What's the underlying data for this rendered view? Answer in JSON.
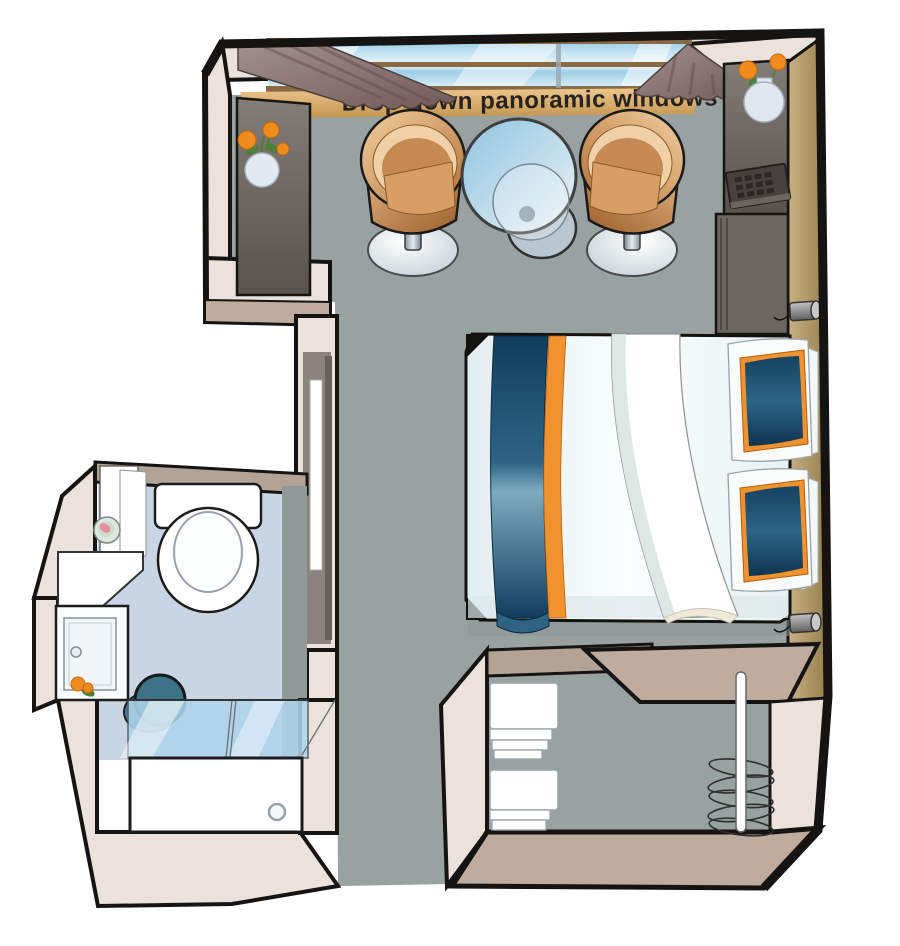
{
  "title": "Cabin floor plan",
  "labels": {
    "windows": "Drop-down panoramic windows"
  },
  "palette": {
    "floor": "#98A2A0",
    "bath_floor": "#C9D5E3",
    "wall_light": "#EAE2DB",
    "wall_band": "#B3A396",
    "wall_band_warm": "#BEAC9E",
    "outline": "#161412",
    "wall_tan_1": "#C8B183",
    "wall_tan_2": "#97814F",
    "console_1": "#827D78",
    "console_2": "#57524D",
    "curtain_1": "#A3918E",
    "curtain_2": "#6F5B58",
    "glass_1": "#9ECFE6",
    "glass_2": "#EAF6FA",
    "frame_brown": "#8A6A45",
    "sill_1": "#EDC68D",
    "sill_2": "#C3954F",
    "chair_1": "#F2CFA0",
    "chair_2": "#B06F35",
    "bed_white": "#F2F8F9",
    "runner_dark": "#123D5C",
    "runner_mid": "#2F6486",
    "runner_light": "#7FABC0",
    "orange": "#F0922E",
    "teal": "#3E7286",
    "lamp": "#9A9A9A",
    "flower": "#F08C1E",
    "leaf": "#4E7F3A",
    "text": "#262220",
    "white": "#FFFFFF",
    "shower_glass": "#AFD4EA",
    "recess_gray": "#8A837D"
  },
  "items": [
    "panoramic window",
    "curtain left",
    "curtain right",
    "armchair left",
    "armchair right",
    "cocktail table",
    "double bed",
    "bed runner",
    "pillow",
    "pillow",
    "reading lamp",
    "reading lamp",
    "console with vase",
    "safe keypad",
    "cabinet",
    "full-length mirror",
    "toilet",
    "vanity counter",
    "washbasin cabinet",
    "bathroom mirror",
    "soap dish",
    "shower stool",
    "shower glass screen",
    "shower tray",
    "towel shelves",
    "wardrobe clothes rail",
    "hangers",
    "flower vase",
    "flower vase",
    "entrance opening"
  ]
}
